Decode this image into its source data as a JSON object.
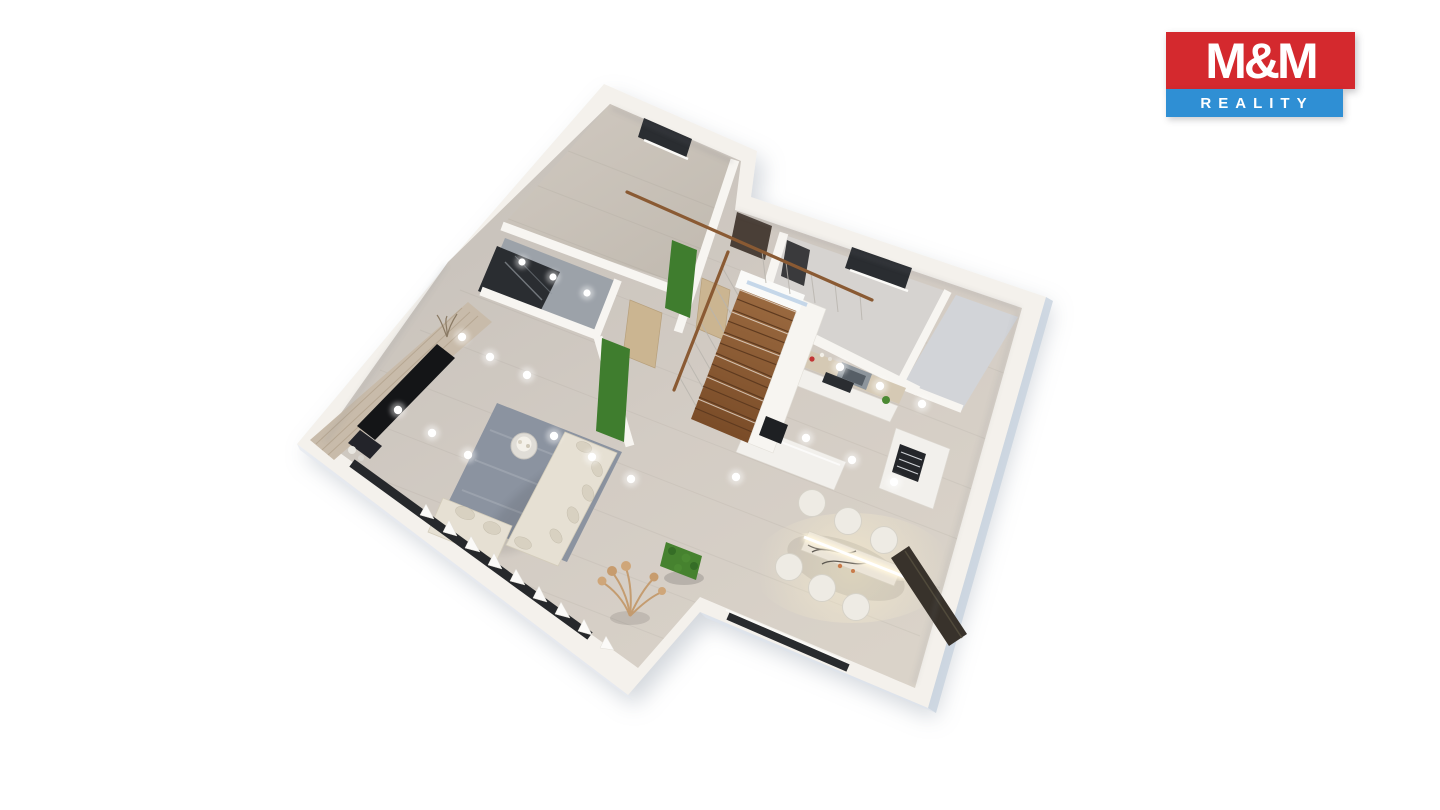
{
  "page": {
    "background": "#ffffff"
  },
  "logo": {
    "title": "M&M",
    "subtitle": "REALITY"
  },
  "palette": {
    "page": "#ffffff",
    "logo_red": "#d4292e",
    "logo_blue": "#2f8fd4",
    "logo_text": "#ffffff",
    "card": "#f4f1ec",
    "wall": "#f7f5f1",
    "side_shade": "#c9d3df",
    "floor_light": "#d9d2c8",
    "floor_dark": "#cbc5be",
    "wing_floor": "#cfc8bf",
    "closet_floor": "#9ca2a9",
    "shelf_dark": "#2a2d31",
    "room_a": "#d6d3d0",
    "room_b": "#d2d4d8",
    "window_dark": "#2a2d31",
    "door_dark": "#4a3f37",
    "door_wood": "#cbb591",
    "green": "#3f7d2e",
    "hedge": "#46822f",
    "beige": "#c8bbaa",
    "tv": "#141517",
    "rug": "#8b93a0",
    "sofa": "#e6e0d3",
    "pillow": "#d8d1c1",
    "stairs_wood": "#8a5a34",
    "rail": "#8a5a33",
    "counter": "#d5c9b4",
    "hood": "#8d959c",
    "cabinet": "#f2f0ec",
    "sideboard": "#38322b",
    "pampas": "#c49a6c",
    "glow": "#fff1c8",
    "spot": "#ffffff"
  },
  "scene": {
    "type": "3d-floor-plan-render",
    "view": "axonometric-top",
    "rooms": [
      "bedroom-wing",
      "walk-in-closet",
      "hallway",
      "entry-vestibule",
      "upper-right-room",
      "corner-room",
      "kitchen",
      "dining-area",
      "living-room",
      "staircase"
    ],
    "features": [
      "wooden-staircase",
      "stair-handrail",
      "glass-balustrade",
      "vertical-garden-panels",
      "boxwood-hedge",
      "pampas-grass",
      "ceiling-spotlights",
      "pendant-light-bar",
      "l-shaped-sofa",
      "area-rug",
      "coffee-table-flowers",
      "tv-panel-wall",
      "dining-table",
      "six-dining-chairs",
      "dark-sideboard",
      "kitchen-island",
      "range-hood",
      "tall-cabinet",
      "entry-door",
      "interior-doors",
      "window-strips"
    ]
  }
}
